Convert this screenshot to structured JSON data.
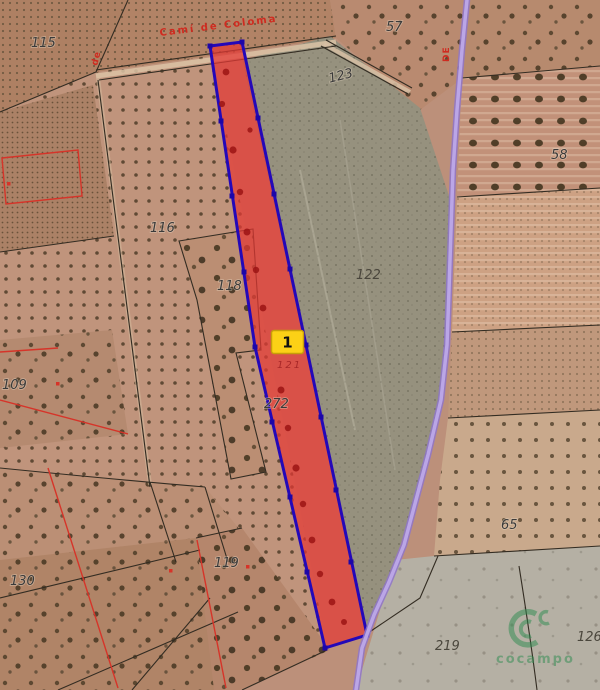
{
  "map": {
    "parcel_labels": [
      {
        "text": "115"
      },
      {
        "text": "57"
      },
      {
        "text": "123"
      },
      {
        "text": "58"
      },
      {
        "text": "116"
      },
      {
        "text": "118"
      },
      {
        "text": "122"
      },
      {
        "text": "109"
      },
      {
        "text": "272"
      },
      {
        "text": "119"
      },
      {
        "text": "130"
      },
      {
        "text": "65"
      },
      {
        "text": "219"
      },
      {
        "text": "126"
      }
    ],
    "road_label": {
      "text": "Camí de Coloma"
    },
    "side_labels": [
      {
        "text": "de"
      },
      {
        "text": "DE"
      }
    ],
    "marker": {
      "label": "1"
    },
    "highlighted_parcel": {
      "number": "121"
    },
    "watermark": {
      "text": "cocampo"
    },
    "colors": {
      "highlight_fill": "#e53935",
      "highlight_stroke": "#2408b8",
      "vertex_square": "#1c06a8",
      "marker_bg": "#fcd116",
      "marker_border": "#c79f08",
      "road_purple": "#a98fd8",
      "cadastral_red": "#d63429",
      "boundary_dark": "#332c22",
      "label_gray": "#3a3a3a",
      "watermark_green": "#2e8b4f"
    }
  }
}
